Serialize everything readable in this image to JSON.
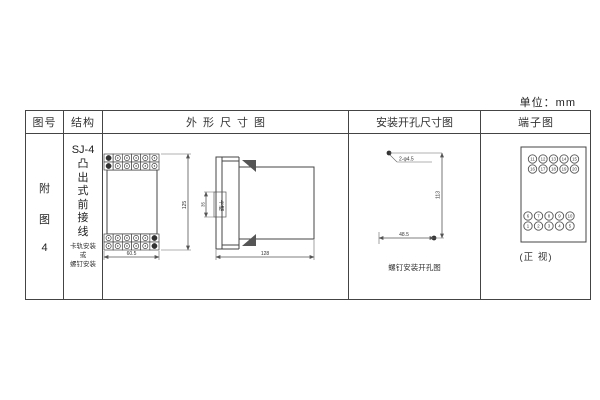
{
  "unit_label": "单位：mm",
  "table": {
    "headers": [
      "图号",
      "结构",
      "外形尺寸图",
      "安装开孔尺寸图",
      "端子图"
    ],
    "figure_no": "附图4",
    "figure_no_chars": [
      "附",
      "图",
      "4"
    ],
    "structure": {
      "model": "SJ-4",
      "type_vertical": "凸出式前接线",
      "mount_note_lines": [
        "卡轨安装",
        "或",
        "螺钉安装"
      ]
    },
    "outline": {
      "front_width": "60.5",
      "front_height": "125",
      "side_depth": "128",
      "rail_slot_width": "35",
      "rail_slot_label": "卡槽"
    },
    "mounting": {
      "holes_label": "2-φ4.5",
      "vertical_pitch": "113",
      "horizontal_pitch": "48.5",
      "caption": "螺钉安装开孔图"
    },
    "terminals": {
      "top_rows": [
        [
          "11",
          "12",
          "13",
          "14",
          "15"
        ],
        [
          "16",
          "17",
          "18",
          "19",
          "20"
        ]
      ],
      "bottom_rows": [
        [
          "6",
          "7",
          "8",
          "9",
          "10"
        ],
        [
          "1",
          "2",
          "3",
          "4",
          "5"
        ]
      ],
      "caption": "(正 视)"
    }
  }
}
